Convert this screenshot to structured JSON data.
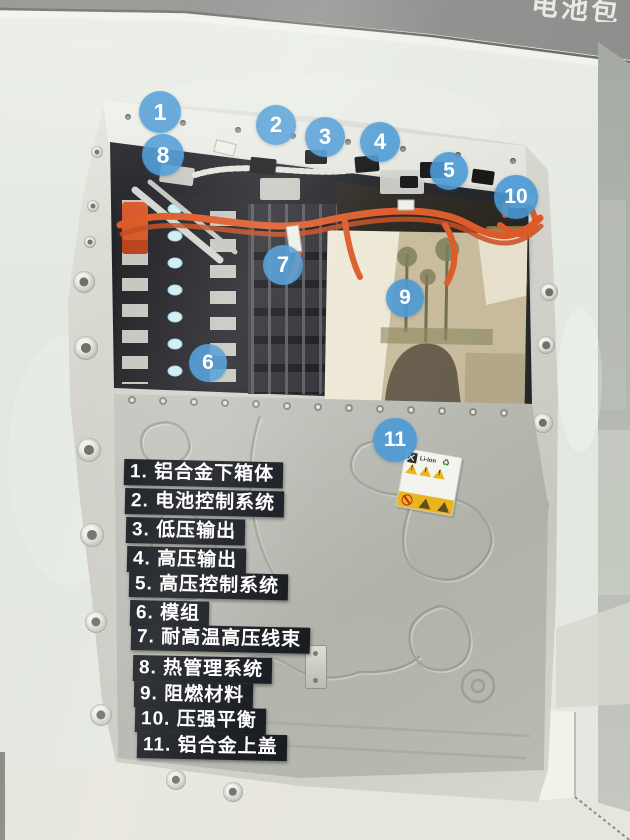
{
  "photo": {
    "top_sign_partial": "电池包",
    "callouts": {
      "c1": "1",
      "c2": "2",
      "c3": "3",
      "c4": "4",
      "c5": "5",
      "c6": "6",
      "c7": "7",
      "c8": "8",
      "c9": "9",
      "c10": "10",
      "c11": "11"
    },
    "legend": {
      "items": [
        "1. 铝合金下箱体",
        "2. 电池控制系统",
        "3. 低压输出",
        "4. 高压输出",
        "5. 高压控制系统",
        "6. 模组",
        "7. 耐高温高压线束",
        "8. 热管理系统",
        "9. 阻燃材料",
        "10. 压强平衡",
        "11. 铝合金上盖"
      ]
    },
    "warning_sticker": {
      "battery_type": "Li-Ion"
    },
    "colors": {
      "callout_blue": "#4a9cd5",
      "legend_black": "#14171d",
      "cable_orange": "#dd5a28",
      "tray_aluminum": "#d2d2cb",
      "cover_aluminum": "#b5b7af",
      "mica_tan": "#c8bb9d",
      "glass_green": "#e2e8e0"
    }
  }
}
